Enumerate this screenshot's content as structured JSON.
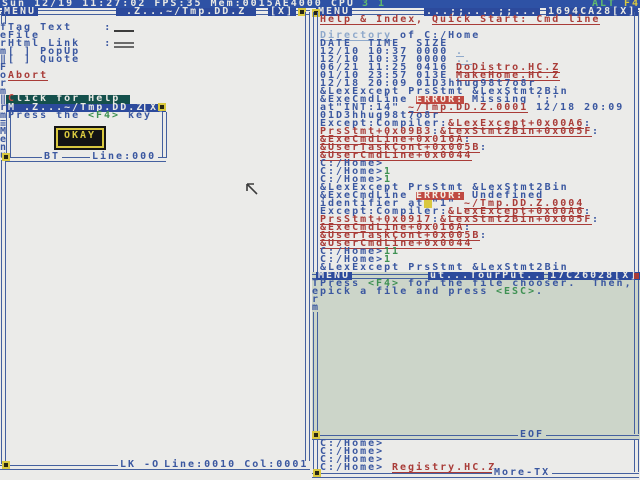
{
  "status_bar": {
    "left_segments": [
      {
        "t": "Sun 12/19 11:27:02 FPS:35 Mem:0015AE4000 CPU ",
        "c": "white"
      },
      {
        "t": "3 1",
        "c": "ltgreen"
      }
    ],
    "right_segments": [
      {
        "t": "ALT",
        "c": "ltgreen"
      },
      {
        "t": " F4",
        "c": "yellow"
      }
    ]
  },
  "left_window": {
    "titlebar": {
      "menu": "MENU",
      "title": " .Z...~/Tmp.DD.Z ",
      "close": "[X]"
    },
    "border_text": [
      "f",
      "e",
      "r",
      "m",
      "‖",
      "F",
      "o",
      "r",
      "m",
      "‖",
      "r",
      "m",
      "≡",
      "M",
      "e",
      "n",
      "u"
    ],
    "form_rows": [
      {
        "y": 24,
        "field": "single",
        "segments": [
          {
            "t": "Tag Text    :",
            "c": "blue"
          }
        ]
      },
      {
        "y": 32,
        "segments": [
          {
            "t": "File",
            "c": "blue"
          }
        ]
      },
      {
        "y": 40,
        "field": "double",
        "segments": [
          {
            "t": "Html Link   :",
            "c": "blue"
          }
        ]
      },
      {
        "y": 48,
        "segments": [
          {
            "t": "[ ] PopUp",
            "c": "blue"
          }
        ]
      },
      {
        "y": 56,
        "segments": [
          {
            "t": "[ ] Quote",
            "c": "blue"
          }
        ]
      },
      {
        "y": 72,
        "segments": [
          {
            "t": "Abort",
            "c": "rlink"
          }
        ]
      }
    ],
    "help_button": {
      "segments": [
        {
          "t": "C",
          "c": "helpC"
        },
        {
          "t": "lick for Help",
          "c": "helpW"
        }
      ]
    },
    "popup": {
      "title": "M .Z...~/Tmp.DD.Z",
      "close": "[X]",
      "message": [
        {
          "t": "Press the ",
          "c": "blue"
        },
        {
          "t": "<F4>",
          "c": "green"
        },
        {
          "t": " key",
          "c": "blue"
        }
      ],
      "okay_label": "OKAY",
      "bottom_flag": "BT",
      "bottom_line": "Line:000"
    },
    "bottom_flags": "LK -O",
    "bottom_position": "Line:0010 Col:0001"
  },
  "right_window": {
    "titlebar": {
      "menu": "MENU",
      "deco": "...;;....;;...",
      "id": "1694CA28",
      "close": "[X]"
    },
    "lines": [
      [
        {
          "t": "Help & Index",
          "c": "rlink"
        },
        {
          "t": ", ",
          "c": "red"
        },
        {
          "t": "Quick Start: Cmd line",
          "c": "rlink"
        }
      ],
      [],
      [
        {
          "t": "Directory",
          "c": "dlink"
        },
        {
          "t": " of C:/Home",
          "c": "blue"
        }
      ],
      [
        {
          "t": "DATE  TIME  SIZE",
          "c": "blue"
        }
      ],
      [
        {
          "t": "12/10 10:37 0000 ",
          "c": "blue"
        },
        {
          "t": ".",
          "c": "dlink"
        }
      ],
      [
        {
          "t": "12/10 10:37 0000 ",
          "c": "blue"
        },
        {
          "t": "..",
          "c": "dlink"
        }
      ],
      [
        {
          "t": "06/21 11:25 0416 ",
          "c": "blue"
        },
        {
          "t": "DoDistro.HC.Z",
          "c": "rlink"
        }
      ],
      [
        {
          "t": "01/10 23:57 013E ",
          "c": "blue"
        },
        {
          "t": "MakeHome.HC.Z",
          "c": "rlink"
        }
      ],
      [
        {
          "t": "12/18 20:09 01D3hhug98t7o8r",
          "c": "blue"
        }
      ],
      [
        {
          "t": "&LexExcept PrsStmt &LexStmt2Bin",
          "c": "blue"
        }
      ],
      [
        {
          "t": "&ExeCmdLine ",
          "c": "blue"
        },
        {
          "t": "ERROR:",
          "c": "err"
        },
        {
          "t": " Missing ';'",
          "c": "blue"
        }
      ],
      [
        {
          "t": "at\"INT:14\" ",
          "c": "blue"
        },
        {
          "t": "~/Tmp.DD.Z.0001",
          "c": "rlink"
        },
        {
          "t": " 12/18 20:09",
          "c": "blue"
        }
      ],
      [
        {
          "t": "01D3hhug98t7o8r",
          "c": "blue"
        }
      ],
      [
        {
          "t": "Except:Compiler:",
          "c": "blue"
        },
        {
          "t": "&LexExcept+0x00A6",
          "c": "rlink"
        },
        {
          "t": ":",
          "c": "blue"
        }
      ],
      [
        {
          "t": "PrsStmt+0x09B3",
          "c": "rlink"
        },
        {
          "t": ":",
          "c": "blue"
        },
        {
          "t": "&LexStmt2Bin+0x005F",
          "c": "rlink"
        },
        {
          "t": ":",
          "c": "blue"
        }
      ],
      [
        {
          "t": "&ExeCmdLine+0x016A",
          "c": "rlink"
        },
        {
          "t": ":",
          "c": "blue"
        }
      ],
      [
        {
          "t": "&UserTaskCont+0x005B",
          "c": "rlink"
        },
        {
          "t": ":",
          "c": "blue"
        }
      ],
      [
        {
          "t": "&UserCmdLine+0x0044",
          "c": "rlink"
        }
      ],
      [
        {
          "t": "C:/Home>",
          "c": "blue"
        }
      ],
      [
        {
          "t": "C:/Home>",
          "c": "blue"
        },
        {
          "t": "1",
          "c": "green"
        }
      ],
      [
        {
          "t": "C:/Home>",
          "c": "blue"
        },
        {
          "t": "1",
          "c": "green"
        }
      ],
      [
        {
          "t": "&LexExcept PrsStmt &LexStmt2Bin",
          "c": "blue"
        }
      ],
      [
        {
          "t": "&ExeCmdLine ",
          "c": "blue"
        },
        {
          "t": "ERROR:",
          "c": "err"
        },
        {
          "t": " Undefined",
          "c": "blue"
        }
      ],
      [
        {
          "t": "identifier at",
          "c": "blue"
        },
        {
          "t": " ",
          "c": "cursor"
        },
        {
          "t": "\"1\" ",
          "c": "blue"
        },
        {
          "t": "~/Tmp.DD.Z.0004",
          "c": "rlink"
        }
      ],
      [
        {
          "t": "Except:Compiler:",
          "c": "blue"
        },
        {
          "t": "&LexExcept+0x00A6",
          "c": "rlink"
        },
        {
          "t": ":",
          "c": "blue"
        }
      ],
      [
        {
          "t": "PrsStmt+0x0917",
          "c": "rlink"
        },
        {
          "t": ":",
          "c": "blue"
        },
        {
          "t": "&LexStmt2Bin+0x005F",
          "c": "rlink"
        },
        {
          "t": ":",
          "c": "blue"
        }
      ],
      [
        {
          "t": "&ExeCmdLine+0x016A",
          "c": "rlink"
        },
        {
          "t": ":",
          "c": "blue"
        }
      ],
      [
        {
          "t": "&UserTaskCont+0x005B",
          "c": "rlink"
        },
        {
          "t": ":",
          "c": "blue"
        }
      ],
      [
        {
          "t": "&UserCmdLine+0x0044",
          "c": "rlink"
        }
      ],
      [
        {
          "t": "C:/Home>",
          "c": "blue"
        },
        {
          "t": "11",
          "c": "green"
        }
      ],
      [
        {
          "t": "C:/Home>",
          "c": "blue"
        },
        {
          "t": "1",
          "c": "green"
        }
      ],
      [
        {
          "t": "&LexExcept PrsStmt &LexStmt2Bin",
          "c": "blue"
        }
      ]
    ],
    "tail_lines": [
      [
        {
          "t": "C:/Home>",
          "c": "blue"
        }
      ],
      [
        {
          "t": "C:/Home>",
          "c": "blue"
        }
      ],
      [
        {
          "t": "C:/Home>",
          "c": "blue"
        }
      ],
      [
        {
          "t": "C:/Home> ",
          "c": "blue"
        },
        {
          "t": "Registry.HC.Z",
          "c": "rlink"
        }
      ]
    ],
    "bottom_more": "More-TX"
  },
  "dialog": {
    "titlebar": {
      "menu": "MENU",
      "deco": "ut...TourPut..",
      "id": "17C26028",
      "close": "[X]"
    },
    "border_text": [
      "T",
      "e",
      "r",
      "m"
    ],
    "lines": [
      [
        {
          "t": "Press ",
          "c": "blue"
        },
        {
          "t": "<F4>",
          "c": "green"
        },
        {
          "t": " for the file chooser.  Then,",
          "c": "blue"
        }
      ],
      [
        {
          "t": "pick a file and press ",
          "c": "blue"
        },
        {
          "t": "<ESC>",
          "c": "green"
        },
        {
          "t": ".",
          "c": "blue"
        }
      ]
    ],
    "eof_label": "EOF"
  }
}
